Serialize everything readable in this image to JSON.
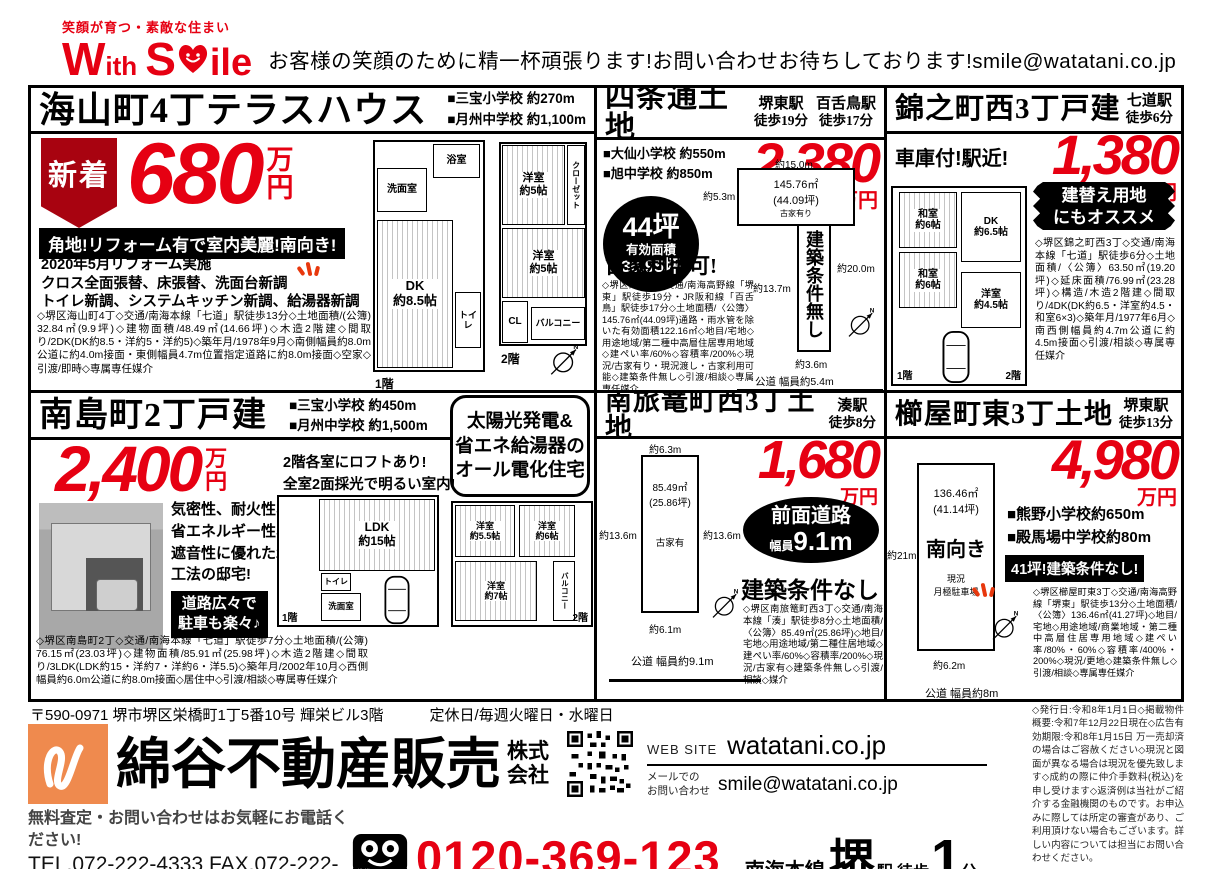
{
  "colors": {
    "accent_red": "#e60012",
    "brand_orange": "#ef8a4e",
    "ribbon_red": "#a80310"
  },
  "header": {
    "tagline": "笑顔が育つ・素敵な住まい",
    "logo_w": "W",
    "logo_ith": "ith",
    "logo_s": "S",
    "logo_ile": "ile",
    "message": "お客様の笑顔のために精一杯頑張ります!お問い合わせお待ちしております!smile@watatani.co.jp"
  },
  "listings": [
    {
      "title": "海山町4丁テラスハウス",
      "schools": [
        "■三宝小学校 約270m",
        "■月州中学校 約1,100m"
      ],
      "new_badge": "新着",
      "price": "680",
      "unit_man": "万",
      "unit_en": "円",
      "banner": "角地!リフォーム有で室内美麗!南向き!",
      "reform": [
        "2020年5月リフォーム実施",
        "クロス全面張替、床張替、洗面台新調",
        "トイレ新調、システムキッチン新調、給湯器新調"
      ],
      "details": "◇堺区海山町4丁◇交通/南海本線「七道」駅徒歩13分◇土地面積/(公簿) 32.84㎡(9.9坪)◇建物面積/48.49㎡(14.66坪)◇木造2階建◇間取り/2DK(DK約8.5・洋約5・洋約5)◇築年月/1978年9月◇南側幅員約8.0m公道に約4.0m接面・東側幅員4.7m位置指定道路に約8.0m接面◇空家◇引渡/即時◇専属専任媒介",
      "floorplan": {
        "rooms1": [
          "洗面室",
          "浴室",
          "DK\n約8.5帖",
          "トイレ"
        ],
        "rooms2": [
          "洋室\n約5帖",
          "クローゼット",
          "洋室\n約5帖",
          "CL",
          "バルコニー"
        ],
        "floor1": "1階",
        "floor2": "2階"
      }
    },
    {
      "title": "四条通土地",
      "stations": [
        {
          "name": "堺東駅",
          "walk": "徒歩19分"
        },
        {
          "name": "百舌鳥駅",
          "walk": "徒歩17分"
        }
      ],
      "schools": [
        "■大仙小学校 約550m",
        "■旭中学校 約850m"
      ],
      "price": "2,380",
      "unit": "万円",
      "circle_badge": {
        "line1": "44坪",
        "line2": "有効面積",
        "line3": "36.95坪"
      },
      "note": "古家利用可!",
      "details": "◇堺区四条通◇交通/南海高野線「堺東」駅徒歩19分・JR阪和線「百舌鳥」駅徒歩17分◇土地面積/〈公簿〉145.76㎡(44.09坪)通路・雨水管を除いた有効面積122.16㎡◇地目/宅地◇用途地域/第二種中高層住居専用地域◇建ぺい率/60%◇容積率/200%◇現況/古家有り・現況渡し・古家利用可能◇建築条件無し◇引渡/相談◇専属専任媒介",
      "diagram": {
        "top": "約15.0m",
        "left": "約5.3m",
        "area": "145.76㎡\n(44.09坪)",
        "note": "古家有り",
        "right": "約20.0m",
        "mid_left": "約13.7m",
        "vertical": "建築条件無し",
        "bottom": "約3.6m",
        "road": "公道 幅員約5.4m"
      }
    },
    {
      "title": "錦之町西3丁戸建",
      "station": {
        "name": "七道駅",
        "walk": "徒歩6分"
      },
      "catch": "車庫付!駅近!",
      "price": "1,380",
      "unit": "万円",
      "badge": "建替え用地\nにもオススメ",
      "details": "◇堺区錦之町西3丁◇交通/南海本線「七道」駅徒歩6分◇土地面積/〈公簿〉63.50㎡(19.20坪)◇延床面積/76.99㎡(23.28坪)◇構造/木造2階建◇間取り/4DK(DK約6.5・洋室約4.5・和室6×3)◇築年月/1977年6月◇南西側幅員約4.7m公道に約4.5m接面◇引渡/相談◇専属専任媒介",
      "floorplan": {
        "rooms": [
          "和室\n約6帖",
          "DK\n約6.5帖",
          "和室\n約6帖",
          "洋室\n約4.5帖"
        ],
        "floor1": "1階",
        "floor2": "2階"
      }
    },
    {
      "title": "南島町2丁戸建",
      "schools": [
        "■三宝小学校 約450m",
        "■月州中学校 約1,500m"
      ],
      "price": "2,400",
      "unit_man": "万",
      "unit_en": "円",
      "feature_box": "太陽光発電&\n省エネ給湯器の\nオール電化住宅",
      "loft_note": "2階各室にロフトあり!\n全室2面採光で明るい室内!",
      "description": "気密性、耐火性、省エネルギー性、遮音性に優れた2×4工法の邸宅!",
      "badge": "道路広々で\n駐車も楽々♪",
      "details": "◇堺区南島町2丁◇交通/南海本線「七道」駅徒歩7分◇土地面積/(公簿) 76.15㎡(23.03坪)◇建物面積/85.91㎡(25.98坪)◇木造2階建◇間取り/3LDK(LDK約15・洋約7・洋約6・洋5.5)◇築年月/2002年10月◇西側幅員約6.0m公道に約8.0m接面◇居住中◇引渡/相談◇専属専任媒介",
      "floorplan": {
        "rooms": [
          "LDK\n約15帖",
          "洗面室",
          "トイレ",
          "洋室\n約5.5帖",
          "洋室\n約6帖",
          "洋室\n約7帖",
          "バルコニー"
        ],
        "floor1": "1階",
        "floor2": "2階"
      }
    },
    {
      "title": "南旅篭町西3丁土地",
      "station": {
        "name": "湊駅",
        "walk": "徒歩8分"
      },
      "price": "1,680",
      "unit": "万円",
      "oval_badge": {
        "line1": "前面道路",
        "line2_small": "幅員",
        "line2_big": "9.1m"
      },
      "heading": "建築条件なし",
      "details": "◇堺区南旅篭町西3丁◇交通/南海本線「湊」駅徒歩8分◇土地面積/〈公簿〉85.49㎡(25.86坪)◇地目/宅地◇用途地域/第二種住居地域◇建ぺい率/60%◇容積率/200%◇現況/古家有◇建築条件無し◇引渡/相談◇媒介",
      "diagram": {
        "top": "約6.3m",
        "area": "85.49㎡\n(25.86坪)",
        "left": "約13.6m",
        "right": "約13.6m",
        "note": "古家有",
        "bottom": "約6.1m",
        "road": "公道 幅員約9.1m"
      }
    },
    {
      "title": "櫛屋町東3丁土地",
      "station": {
        "name": "堺東駅",
        "walk": "徒歩13分"
      },
      "price": "4,980",
      "unit": "万円",
      "schools": [
        "■熊野小学校約650m",
        "■殿馬場中学校約80m"
      ],
      "banner": "41坪!建築条件なし!",
      "details": "◇堺区櫛屋町東3丁◇交通/南海高野線「堺東」駅徒歩13分◇土地面積/〈公簿〉136.46㎡(41.27坪)◇地目/宅地◇用途地域/商業地域・第二種中高層住居専用地域◇建ぺい率/80%・60%◇容積率/400%・200%◇現況/更地◇建築条件無し◇引渡/相談◇専属専任媒介",
      "diagram": {
        "area": "136.46㎡\n(41.14坪)",
        "facing": "南向き",
        "status": "現況\n月極駐車場",
        "left": "約21m",
        "bottom": "約6.2m",
        "road": "公道 幅員約8m"
      }
    }
  ],
  "footer": {
    "postal_address": "〒590-0971 堺市堺区栄橋町1丁5番10号 輝栄ビル3階",
    "holiday": "定休日/毎週火曜日・水曜日",
    "company_name": "綿谷不動産販売",
    "company_suffix1": "株式",
    "company_suffix2": "会社",
    "web_label": "WEB SITE",
    "web_url": "watatani.co.jp",
    "mail_label": "メールでの\nお問い合わせ",
    "mail_address": "smile@watatani.co.jp",
    "call_note": "無料査定・お問い合わせはお気軽にお電話ください!",
    "tel_fax": "TEL.072-222-4333 FAX.072-222-4334",
    "freedial_note": "携帯・PHS OK",
    "freedial": "0120-369-123",
    "rail_line": "南海本線",
    "station_name": "堺",
    "station_mid": "駅 徒歩",
    "station_num": "1",
    "station_unit": "分",
    "legal": "◇発行日:令和8年1月1日◇掲載物件概要:令和7年12月22日現在◇広告有効期限:令和8年1月15日 万一売却済の場合はご容赦ください◇現況と図面が異なる場合は現況を優先致します◇成約の際に仲介手数料(税込)を申し受けます◇返済例は当社がご紹介する金融機関のものです。お申込みに際しては所定の審査があり、ご利用頂けない場合もございます。詳しい内容については担当にお問い合わせください。"
  }
}
